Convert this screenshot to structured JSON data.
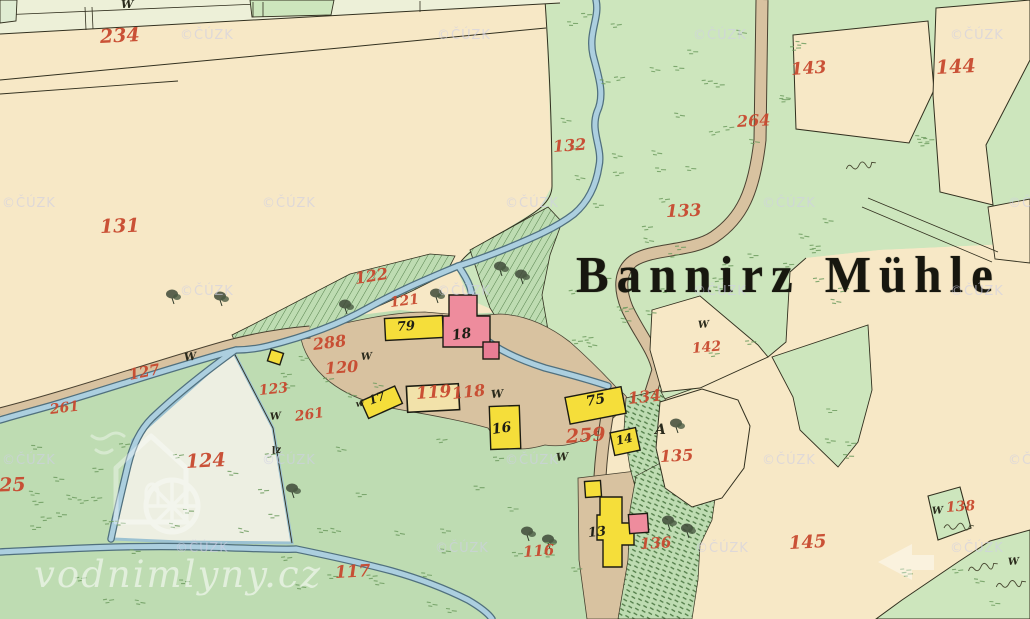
{
  "map_title": {
    "text": "Bannirz Mühle",
    "word1": "Bannirz",
    "word2": "Mühle"
  },
  "watermarks": {
    "copyright_text": "©ČÚZK",
    "copyright_positions": [
      [
        180,
        28
      ],
      [
        437,
        28
      ],
      [
        693,
        28
      ],
      [
        950,
        28
      ],
      [
        2,
        196
      ],
      [
        262,
        196
      ],
      [
        505,
        196
      ],
      [
        762,
        196
      ],
      [
        1008,
        196
      ],
      [
        180,
        284
      ],
      [
        437,
        284
      ],
      [
        693,
        284
      ],
      [
        950,
        284
      ],
      [
        2,
        453
      ],
      [
        262,
        453
      ],
      [
        505,
        453
      ],
      [
        762,
        453
      ],
      [
        1008,
        453
      ],
      [
        175,
        541
      ],
      [
        435,
        541
      ],
      [
        695,
        541
      ],
      [
        950,
        541
      ]
    ],
    "site_text": "vodnimlyny.cz"
  },
  "labels": {
    "parcels": [
      {
        "t": "234",
        "x": 100,
        "y": 28,
        "s": 19,
        "r": -3
      },
      {
        "t": "131",
        "x": 100,
        "y": 218,
        "s": 19,
        "r": -2
      },
      {
        "t": "132",
        "x": 553,
        "y": 139,
        "s": 16,
        "r": -4
      },
      {
        "t": "133",
        "x": 666,
        "y": 204,
        "s": 17,
        "r": -2
      },
      {
        "t": "143",
        "x": 791,
        "y": 62,
        "s": 17,
        "r": -4
      },
      {
        "t": "144",
        "x": 936,
        "y": 59,
        "s": 19,
        "r": -3
      },
      {
        "t": "264",
        "x": 737,
        "y": 114,
        "s": 16,
        "r": -3
      },
      {
        "t": "122",
        "x": 355,
        "y": 271,
        "s": 16,
        "r": -9
      },
      {
        "t": "121",
        "x": 390,
        "y": 296,
        "s": 14,
        "r": -7
      },
      {
        "t": "288",
        "x": 313,
        "y": 337,
        "s": 16,
        "r": -7
      },
      {
        "t": "120",
        "x": 325,
        "y": 361,
        "s": 16,
        "r": -4
      },
      {
        "t": "127",
        "x": 129,
        "y": 368,
        "s": 15,
        "r": -11
      },
      {
        "t": "261",
        "x": 50,
        "y": 403,
        "s": 14,
        "r": -7
      },
      {
        "t": "261",
        "x": 295,
        "y": 410,
        "s": 14,
        "r": -8
      },
      {
        "t": "123",
        "x": 259,
        "y": 384,
        "s": 14,
        "r": -6
      },
      {
        "t": "124",
        "x": 186,
        "y": 453,
        "s": 19,
        "r": -3
      },
      {
        "t": "125",
        "x": -14,
        "y": 477,
        "s": 19,
        "r": -2
      },
      {
        "t": "119",
        "x": 416,
        "y": 386,
        "s": 17,
        "r": -4
      },
      {
        "t": "118",
        "x": 452,
        "y": 386,
        "s": 16,
        "r": -6
      },
      {
        "t": "142",
        "x": 692,
        "y": 342,
        "s": 14,
        "r": -5
      },
      {
        "t": "134",
        "x": 628,
        "y": 391,
        "s": 16,
        "r": -6
      },
      {
        "t": "259",
        "x": 566,
        "y": 428,
        "s": 19,
        "r": -4
      },
      {
        "t": "135",
        "x": 660,
        "y": 449,
        "s": 16,
        "r": -3
      },
      {
        "t": "116",
        "x": 523,
        "y": 545,
        "s": 15,
        "r": -4
      },
      {
        "t": "117",
        "x": 335,
        "y": 565,
        "s": 17,
        "r": -3
      },
      {
        "t": "136",
        "x": 640,
        "y": 537,
        "s": 15,
        "r": -3
      },
      {
        "t": "145",
        "x": 789,
        "y": 535,
        "s": 18,
        "r": -3
      },
      {
        "t": "138",
        "x": 946,
        "y": 501,
        "s": 14,
        "r": -4
      }
    ],
    "buildings": [
      {
        "t": "79",
        "x": 397,
        "y": 321,
        "s": 13,
        "r": -4
      },
      {
        "t": "18",
        "x": 452,
        "y": 329,
        "s": 14,
        "r": -8
      },
      {
        "t": "17",
        "x": 369,
        "y": 395,
        "s": 12,
        "r": -20
      },
      {
        "t": "16",
        "x": 492,
        "y": 423,
        "s": 14,
        "r": -8
      },
      {
        "t": "75",
        "x": 586,
        "y": 395,
        "s": 14,
        "r": -10
      },
      {
        "t": "14",
        "x": 616,
        "y": 435,
        "s": 12,
        "r": -12
      },
      {
        "t": "13",
        "x": 588,
        "y": 527,
        "s": 13,
        "r": -6
      }
    ],
    "letters": [
      {
        "t": "W",
        "x": 121,
        "y": -1,
        "s": 11,
        "r": 0
      },
      {
        "t": "W",
        "x": 184,
        "y": 352,
        "s": 11,
        "r": -6
      },
      {
        "t": "W",
        "x": 270,
        "y": 413,
        "s": 10,
        "r": -6
      },
      {
        "t": "W",
        "x": 361,
        "y": 353,
        "s": 10,
        "r": -4
      },
      {
        "t": "w",
        "x": 356,
        "y": 401,
        "s": 9,
        "r": -10
      },
      {
        "t": "W",
        "x": 491,
        "y": 389,
        "s": 11,
        "r": -4
      },
      {
        "t": "W",
        "x": 556,
        "y": 452,
        "s": 11,
        "r": -4
      },
      {
        "t": "W",
        "x": 698,
        "y": 321,
        "s": 10,
        "r": -4
      },
      {
        "t": "W",
        "x": 932,
        "y": 507,
        "s": 10,
        "r": -4
      },
      {
        "t": "W",
        "x": 1008,
        "y": 558,
        "s": 10,
        "r": -4
      },
      {
        "t": "A",
        "x": 655,
        "y": 423,
        "s": 14,
        "r": 0
      },
      {
        "t": "lz",
        "x": 272,
        "y": 447,
        "s": 10,
        "r": -10
      }
    ]
  },
  "features": {
    "trees": [
      [
        500,
        266
      ],
      [
        521,
        274
      ],
      [
        436,
        293
      ],
      [
        345,
        304
      ],
      [
        172,
        294
      ],
      [
        220,
        296
      ],
      [
        292,
        488
      ],
      [
        676,
        423
      ],
      [
        527,
        531
      ],
      [
        548,
        539
      ],
      [
        668,
        520
      ],
      [
        687,
        528
      ]
    ],
    "scribbles": [
      [
        846,
        166,
        -8
      ],
      [
        944,
        525,
        0
      ],
      [
        968,
        568,
        -10
      ],
      [
        996,
        584,
        -6
      ]
    ]
  },
  "colors": {
    "paper": "#f7e8c6",
    "meadow": "#bedcb2",
    "meadow_light": "#cde6bd",
    "pond": "#edefe2",
    "water": "#accfdf",
    "water_edge": "#50707e",
    "road": "#d8c2a0",
    "road_edge": "#4a4231",
    "building_wood": "#f5de3a",
    "building_stone": "#ee8c9d",
    "building_pale": "#f2e2aa",
    "label_red": "#c8492f",
    "ink": "#32301f",
    "hatch": "#55814c",
    "tuft": "#6f9c60"
  }
}
